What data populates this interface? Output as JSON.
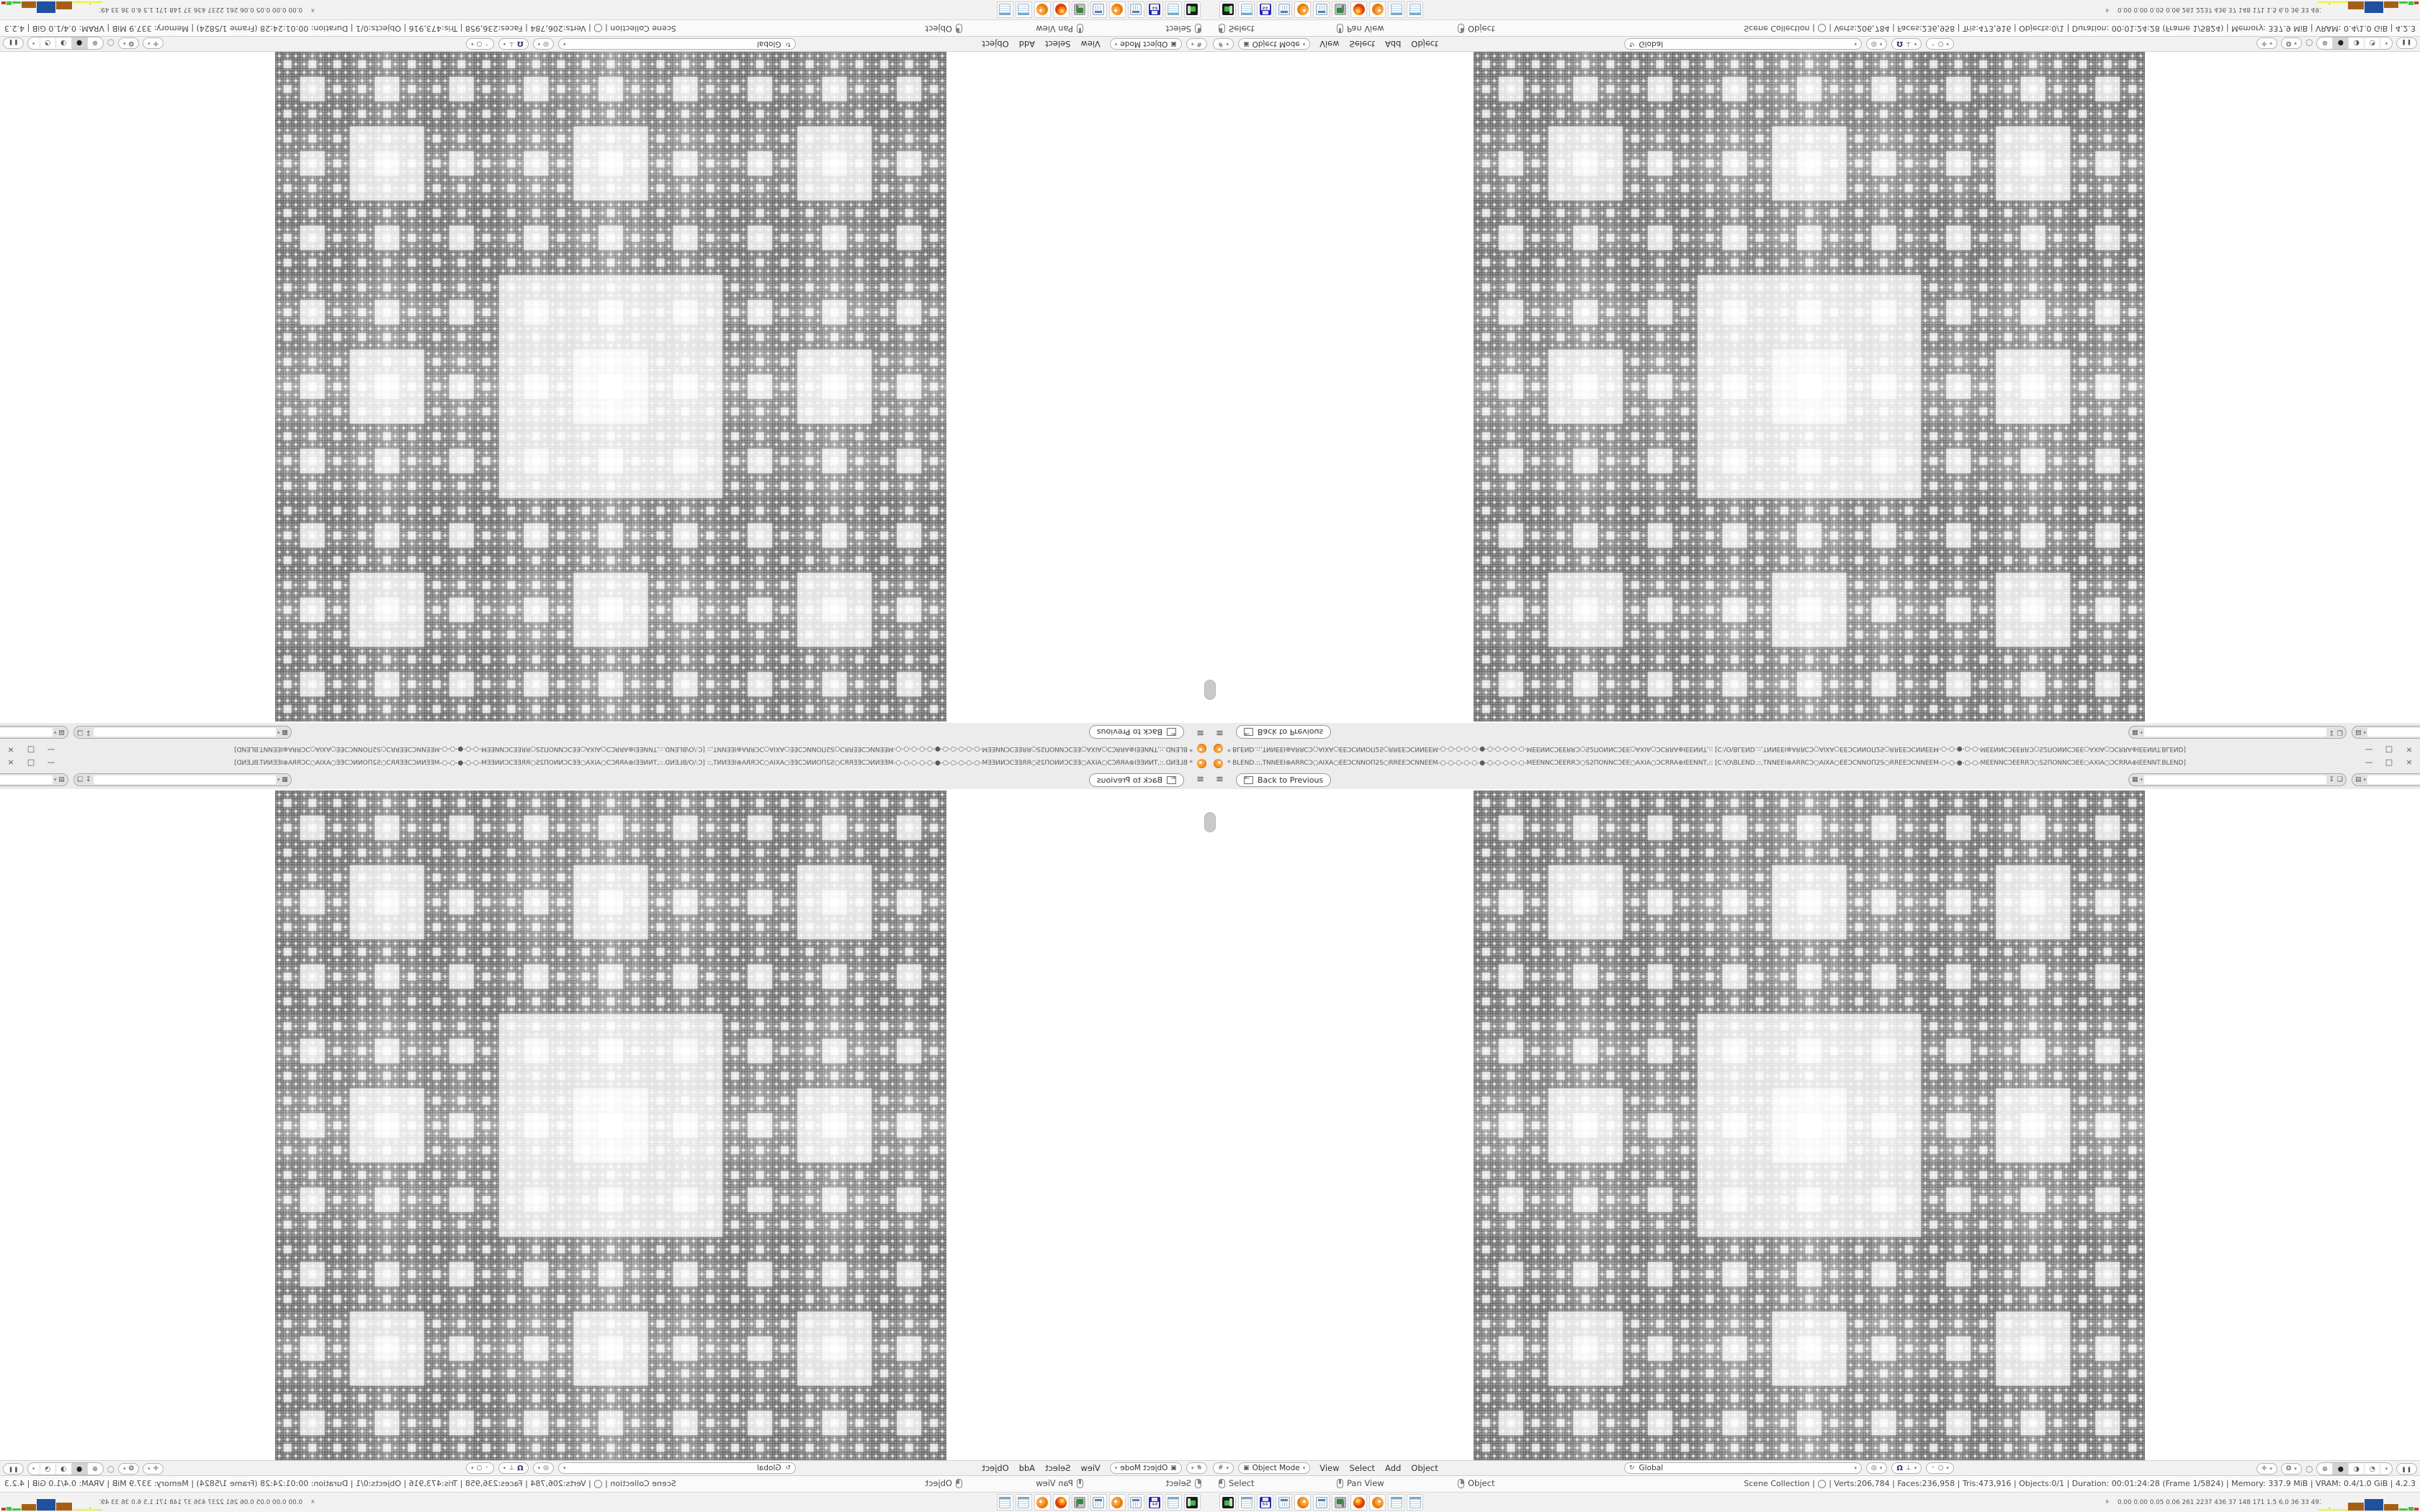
{
  "app": {
    "title_text": "* BLEND.::,TNNEEI⊕ARRCƆ○AIXA○EEƆCNNOΠ2S○RREEƆCNNEEM-○-○-○-○-○-●-○-○-○-○-○-MEENNCƆEERRƆ○S2ΠONNCƆEE○AXIA○ƆCRRA⊕IEENNT,:: [C:\\O\\BLEND.::,TNNEEI⊕ARRCƆ○AIXA○EEƆCNNOΠ2S○RREEƆCNNEEM-○-○-●-○-○-MEENNCƆEERRƆ○S2ΠONNCƆEE○AXIA○ƆCRRA⊕IEENNT.BLEND]",
    "window_controls": [
      "—",
      "□",
      "×"
    ]
  },
  "topbar": {
    "menu_icon": "≡",
    "back_button": {
      "arrow_icon": "←",
      "label": "Back to Previous"
    },
    "scene_selector": {
      "icon": "▦",
      "dropdown": "▾",
      "value": "",
      "pin_icon": "↧",
      "copy_icon": "❏"
    },
    "view_layer_selector": {
      "icon": "▤",
      "dropdown": "▾",
      "value": "",
      "copy_icon": "❏"
    }
  },
  "viewport": {
    "header": {
      "editor_icon": "#",
      "editor_dropdown": "▾",
      "mode": {
        "icon": "▣",
        "label": "Object Mode",
        "dropdown": "▾"
      },
      "menus": [
        "View",
        "Select",
        "Add",
        "Object"
      ],
      "orientation": {
        "icon": "↻",
        "label": "Global",
        "dropdown": "▾"
      },
      "pivot": {
        "icon": "◎",
        "dropdown": "▾"
      },
      "snap": {
        "magnet_icon": "Ω",
        "target_icon": "⊥",
        "dropdown": "▾"
      },
      "proportional": {
        "dot_icon": "◦",
        "circle_icon": "○",
        "dropdown": "▾"
      },
      "gizmo": {
        "icon": "✛",
        "dropdown": "▾"
      },
      "overlays": {
        "icon": "❂",
        "dropdown": "▾"
      },
      "xray_icon": "○",
      "shading": {
        "modes": [
          "⊕",
          "●",
          "◑",
          "◔"
        ],
        "selected_index": 1,
        "dropdown": "▾"
      },
      "pause_icon": "❚❚"
    }
  },
  "statusbar": {
    "hints": [
      {
        "button": "left",
        "label": "Select"
      },
      {
        "button": "middle",
        "label": "Pan View"
      },
      {
        "button": "right",
        "label": "Object"
      }
    ],
    "stats": [
      "Scene Collection",
      "◯",
      "Verts:206,784",
      "Faces:236,958",
      "Tris:473,916",
      "Objects:0/1",
      "Duration: 00:01:24:28 (Frame 1/5824)",
      "Memory: 337.9 MiB",
      "VRAM: 0.4/1.0 GiB",
      "4.2.3"
    ],
    "separator": " | "
  },
  "taskbar": {
    "apps": [
      {
        "id": "disk-emulator",
        "type": "drive"
      },
      {
        "id": "notepad-1",
        "type": "notepad"
      },
      {
        "id": "c64-emulator",
        "type": "floppy",
        "label": "64"
      },
      {
        "id": "calculator-1",
        "type": "calc"
      },
      {
        "id": "blender-1",
        "type": "blender"
      },
      {
        "id": "calculator-2",
        "type": "calc"
      },
      {
        "id": "capture-monitor",
        "type": "monitor"
      },
      {
        "id": "firefox",
        "type": "firefox"
      },
      {
        "id": "blender-2",
        "type": "blender"
      },
      {
        "id": "notepad-2",
        "type": "notepad"
      },
      {
        "id": "notepad-3",
        "type": "notepad"
      }
    ],
    "expand_chevron": "»",
    "sensor_values": [
      "0.00",
      "0.00",
      "0.05",
      "0.06",
      "261",
      "2237",
      "436",
      "37",
      "148",
      "171",
      "1.5",
      "6.0",
      "36",
      "33",
      "49147201"
    ],
    "graph_bars": [
      {
        "color": "#f0ef30",
        "w": 14,
        "h": 2
      },
      {
        "color": "#f0ef30",
        "w": 3,
        "h": 5
      },
      {
        "color": "#f0ef30",
        "w": 22,
        "h": 2
      },
      {
        "color": "#a55f14",
        "w": 22,
        "h": 11
      },
      {
        "color": "#20509e",
        "w": 26,
        "h": 16
      },
      {
        "color": "#a55f14",
        "w": 20,
        "h": 9
      },
      {
        "color": "#3fc43f",
        "w": 12,
        "h": 3
      },
      {
        "color": "#3fc43f",
        "w": 7,
        "h": 5
      },
      {
        "color": "#cf3a2a",
        "w": 6,
        "h": 4
      }
    ]
  },
  "fractal": {
    "grid": 729,
    "levels": 6,
    "plaid_base": 0.38,
    "plaid_step": 0.05,
    "plaid_max": 0.8,
    "hole_base": 0.845,
    "hole_step": 0.012,
    "sparkle": 0.055
  },
  "layout_note": "screen is a 2x2 mirror tiling of one 1680x1050 Blender screenshot"
}
